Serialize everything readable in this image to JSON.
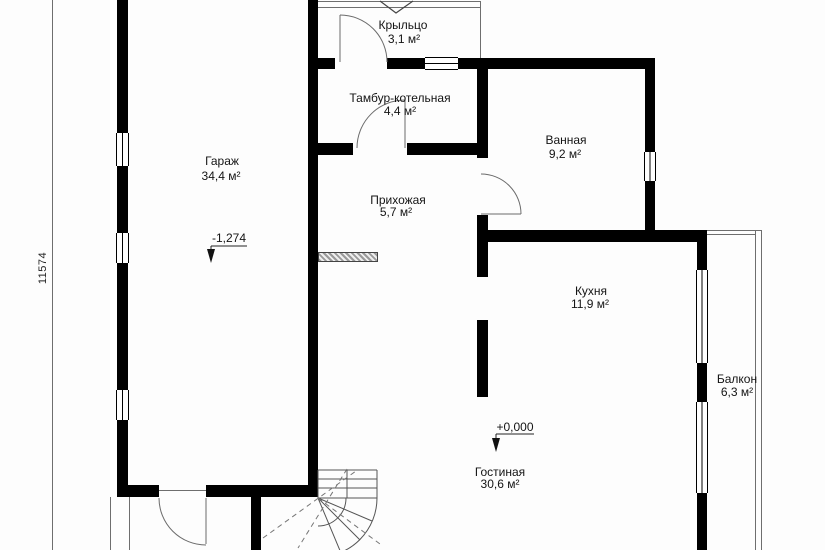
{
  "plan": {
    "type": "floor-plan",
    "rooms": [
      {
        "id": "porch",
        "name": "Крыльцо",
        "area": "3,1 м²"
      },
      {
        "id": "vestibule",
        "name": "Тамбур-котельная",
        "area": "4,4 м²"
      },
      {
        "id": "bathroom",
        "name": "Ванная",
        "area": "9,2 м²"
      },
      {
        "id": "garage",
        "name": "Гараж",
        "area": "34,4 м²"
      },
      {
        "id": "hallway",
        "name": "Прихожая",
        "area": "5,7 м²"
      },
      {
        "id": "kitchen",
        "name": "Кухня",
        "area": "11,9 м²"
      },
      {
        "id": "balcony",
        "name": "Балкон",
        "area": "6,3 м²"
      },
      {
        "id": "living",
        "name": "Гостиная",
        "area": "30,6 м²"
      }
    ],
    "elevation_marks": [
      {
        "id": "garage-level",
        "label": "-1,274"
      },
      {
        "id": "floor-level",
        "label": "+0,000"
      }
    ],
    "dimensions": [
      {
        "id": "left-height",
        "label": "11574"
      }
    ]
  },
  "colors": {
    "wall": "#000000",
    "linework": "#666666",
    "background": "#ffffff",
    "text": "#141414"
  }
}
